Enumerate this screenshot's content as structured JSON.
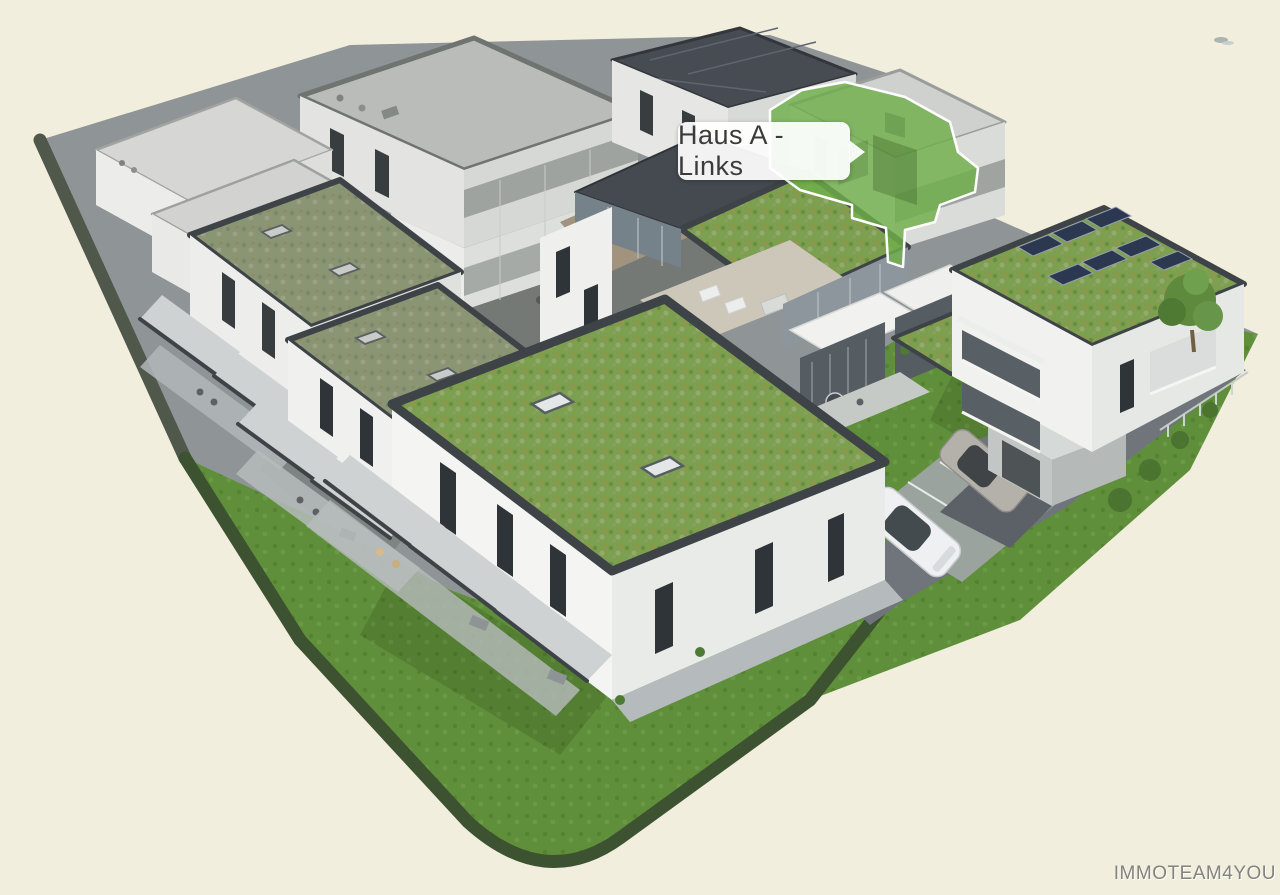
{
  "viewport": {
    "width": 1280,
    "height": 895
  },
  "tooltip": {
    "text": "Haus A - Links"
  },
  "watermark": {
    "text": "IMMOTEAM4YOU"
  },
  "buildings": {
    "highlighted": {
      "label": "Haus A - Links",
      "state": "highlighted-green"
    }
  },
  "icons": {
    "tooltip_arrow": "arrow-right-icon",
    "distant_bird": "bird-icon"
  },
  "colors": {
    "background": "#f2eedd",
    "grass": "#5f8f3a",
    "hedge": "#3d5230",
    "sedum": "#7d9f50",
    "sedum-dull": "#8a9573",
    "highlight": "#6fae4b",
    "wall": "#f3f4f2",
    "wall-shade": "#e3e5e2",
    "parapet": "#3e4347",
    "paving": "#8f9496",
    "paving-dark": "#747976",
    "road": "#6f757b",
    "gray-roof": "#b9bcb8",
    "solar": "#2e3a52",
    "label-text": "#3b3b3b",
    "watermark": "#83837c"
  }
}
